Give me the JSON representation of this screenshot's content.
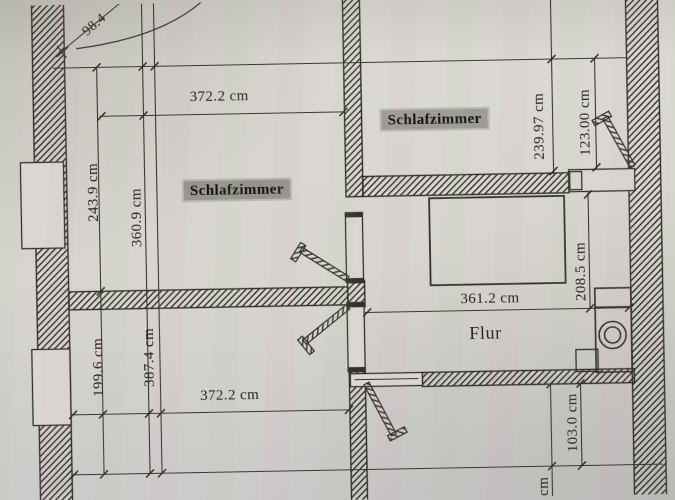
{
  "rooms": {
    "bedroom_left": "Schlafzimmer",
    "bedroom_right": "Schlafzimmer",
    "hallway": "Flur"
  },
  "dimensions": {
    "top_width": "372.2 cm",
    "upper_left_outer": "243.9 cm",
    "upper_left_inner": "360.9 cm",
    "upper_right_outer": "239.97 cm",
    "upper_right_inner": "123.00 cm",
    "hall_width": "361.2 cm",
    "hall_height": "208.5 cm",
    "lower_left_outer": "199.6 cm",
    "lower_left_inner": "387.4 cm",
    "bottom_width": "372.2 cm",
    "lower_right_height": "103.0 cm",
    "diagonal_top_left": "98.4",
    "partial_bottom_unit": "cm"
  },
  "colors": {
    "paper": "#d8d5d0",
    "ink": "#34312c",
    "label_highlight": "#97948f"
  }
}
